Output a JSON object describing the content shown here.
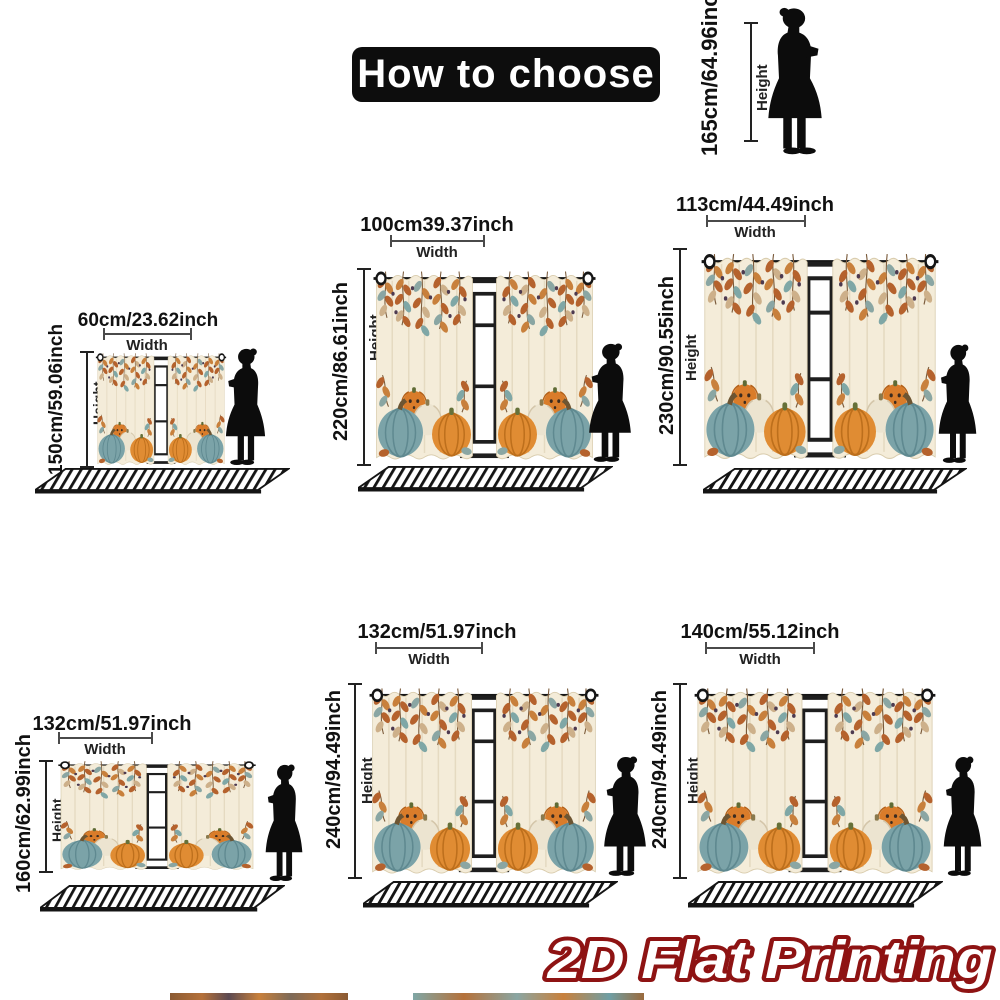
{
  "title": "How to choose",
  "reference": {
    "height_label": "165cm/64.96inch"
  },
  "labels": {
    "width": "Width",
    "height": "Height"
  },
  "sizes": [
    {
      "width_label": "60cm/23.62inch",
      "height_label": "150cm/59.06inch"
    },
    {
      "width_label": "100cm39.37inch",
      "height_label": "220cm/86.61inch"
    },
    {
      "width_label": "113cm/44.49inch",
      "height_label": "230cm/90.55inch"
    },
    {
      "width_label": "132cm/51.97inch",
      "height_label": "160cm/62.99inch"
    },
    {
      "width_label": "132cm/51.97inch",
      "height_label": "240cm/94.49inch"
    },
    {
      "width_label": "140cm/55.12inch",
      "height_label": "240cm/94.49inch"
    }
  ],
  "watermark": "2D Flat Printing",
  "colors": {
    "title_bg": "#0d0d0d",
    "title_text": "#ffffff",
    "measure_line": "#222222",
    "silhouette": "#0c0c0c",
    "watermark_fill": "#ffffff",
    "watermark_stroke": "#8e1313",
    "curtain_background": "#f4ecd9",
    "pumpkin_orange": "#e08c33",
    "pumpkin_teal": "#7ba3a8",
    "pumpkin_cream": "#ece4d0",
    "leaf_rust": "#b5622d"
  }
}
